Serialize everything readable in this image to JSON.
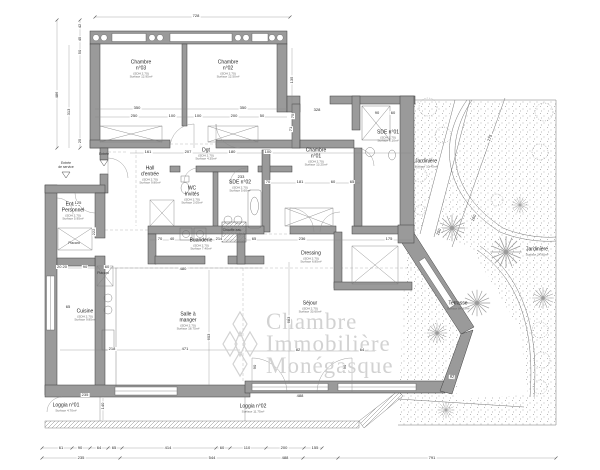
{
  "title": "Plan d'appartement",
  "watermark": {
    "line1": "Chambre",
    "line2": "Immobilière",
    "line3": "Monégasque",
    "color": "#d2d2d2"
  },
  "plan": {
    "rooms": [
      {
        "id": "chambre-03",
        "label": "Chambre\nn°03",
        "sub": [
          "(SDH 2.70)",
          "Surface 12.95m²"
        ],
        "x": 141,
        "y": 70
      },
      {
        "id": "chambre-02",
        "label": "Chambre\nn°02",
        "sub": [
          "(SDH 2.70)",
          "Surface 12.50m²"
        ],
        "x": 228,
        "y": 70
      },
      {
        "id": "chambre-01",
        "label": "Chambre\nn°01",
        "sub": [
          "(SDH 2.70)",
          "Surface 13.25m²"
        ],
        "x": 316,
        "y": 158
      },
      {
        "id": "hall-entree",
        "label": "Hall\nd'entrée",
        "sub": [
          "(SDH 2.70)",
          "Surface 9.80m²"
        ],
        "x": 150,
        "y": 176
      },
      {
        "id": "wc-invites",
        "label": "WC\nInvités",
        "sub": [
          "(SDH 2.70)",
          "Surface 2.05m²"
        ],
        "x": 192,
        "y": 196
      },
      {
        "id": "degagement",
        "label": "Dgt",
        "sub": [
          "(SDH 2.70)",
          "Surface 4.35m²"
        ],
        "x": 206,
        "y": 155
      },
      {
        "id": "sde-02",
        "label": "SDE n°02",
        "sub": [
          "(SDH 2.70)",
          "Surface 5.60m²"
        ],
        "x": 240,
        "y": 187
      },
      {
        "id": "sde-01",
        "label": "SDE n°01",
        "sub": [
          "(SDH 2.70)",
          "Surface 6.10m²"
        ],
        "x": 388,
        "y": 137
      },
      {
        "id": "dressing",
        "label": "Dressing",
        "sub": [
          "(SDH 2.70)",
          "Surface 6.85m²"
        ],
        "x": 311,
        "y": 258
      },
      {
        "id": "buanderie",
        "label": "Buanderie",
        "sub": [
          "(SDH 2.70)",
          "Surface 7.40m²"
        ],
        "x": 201,
        "y": 245
      },
      {
        "id": "chauffe-eau",
        "label": "Chauffe-eau",
        "sub": [],
        "small": true,
        "x": 232,
        "y": 231
      },
      {
        "id": "entree-service",
        "label": "Entrée\nde service",
        "sub": [],
        "small": true,
        "x": 66,
        "y": 166
      },
      {
        "id": "entree",
        "label": "Entrée",
        "sub": [],
        "small": true,
        "x": 104,
        "y": 155
      },
      {
        "id": "entree-personnel",
        "label": "Entrée\nPersonnel",
        "sub": [
          "(SDH 2.70)",
          "Surface 5.95m²"
        ],
        "x": 73,
        "y": 212
      },
      {
        "id": "placard-1",
        "label": "Placard",
        "sub": [],
        "small": true,
        "x": 74,
        "y": 244
      },
      {
        "id": "placard-2",
        "label": "Placard",
        "sub": [],
        "small": true,
        "x": 103,
        "y": 274
      },
      {
        "id": "cuisine",
        "label": "Cuisine",
        "sub": [
          "(SDH 2.70)",
          "Surface 9.85m²"
        ],
        "x": 85,
        "y": 316
      },
      {
        "id": "salle-a-manger",
        "label": "Salle à\nmanger",
        "sub": [
          "(SDH 2.70)",
          "Surface 18.75m²"
        ],
        "x": 188,
        "y": 322
      },
      {
        "id": "sejour",
        "label": "Séjour",
        "sub": [
          "(SDH 2.70)",
          "Surface 33.60m²"
        ],
        "x": 310,
        "y": 308
      },
      {
        "id": "loggia-01",
        "label": "Loggia n°01",
        "sub": [
          "Surface 4.70m²"
        ],
        "x": 66,
        "y": 408
      },
      {
        "id": "loggia-02",
        "label": "Loggia n°02",
        "sub": [
          "Surface 11.75m²"
        ],
        "x": 253,
        "y": 409
      },
      {
        "id": "terrasse",
        "label": "Terrasse",
        "sub": [
          "Surface 84.95m²"
        ],
        "x": 458,
        "y": 306
      },
      {
        "id": "jardiniere-1",
        "label": "Jardinière",
        "sub": [
          "Surface 10.45m²"
        ],
        "x": 426,
        "y": 164
      },
      {
        "id": "jardiniere-2",
        "label": "Jardinière",
        "sub": [
          "Surface 24.80m²"
        ],
        "x": 537,
        "y": 252
      }
    ],
    "dimensions": [
      {
        "t": "728",
        "x": 196,
        "y": 16
      },
      {
        "t": "350",
        "x": 137,
        "y": 108
      },
      {
        "t": "350",
        "x": 243,
        "y": 108
      },
      {
        "t": "250",
        "x": 134,
        "y": 116
      },
      {
        "t": "100",
        "x": 172,
        "y": 116
      },
      {
        "t": "100",
        "x": 198,
        "y": 116
      },
      {
        "t": "200",
        "x": 234,
        "y": 116
      },
      {
        "t": "50",
        "x": 262,
        "y": 116
      },
      {
        "t": "42",
        "x": 80,
        "y": 26,
        "rot": -90
      },
      {
        "t": "45",
        "x": 80,
        "y": 39,
        "rot": -90
      },
      {
        "t": "50",
        "x": 80,
        "y": 52,
        "rot": -90
      },
      {
        "t": "486",
        "x": 57,
        "y": 95,
        "rot": -90
      },
      {
        "t": "313",
        "x": 69,
        "y": 112,
        "rot": -90
      },
      {
        "t": "25",
        "x": 80,
        "y": 141,
        "rot": -90
      },
      {
        "t": "135",
        "x": 292,
        "y": 80,
        "rot": -90
      },
      {
        "t": "75",
        "x": 293,
        "y": 116,
        "rot": -90
      },
      {
        "t": "71",
        "x": 291,
        "y": 129,
        "rot": -90
      },
      {
        "t": "161",
        "x": 148,
        "y": 152
      },
      {
        "t": "207",
        "x": 188,
        "y": 152
      },
      {
        "t": "180",
        "x": 232,
        "y": 152
      },
      {
        "t": "100",
        "x": 268,
        "y": 152
      },
      {
        "t": "328",
        "x": 317,
        "y": 110
      },
      {
        "t": "90",
        "x": 377,
        "y": 113
      },
      {
        "t": "60",
        "x": 393,
        "y": 113
      },
      {
        "t": "70",
        "x": 268,
        "y": 182
      },
      {
        "t": "181",
        "x": 300,
        "y": 182
      },
      {
        "t": "60",
        "x": 333,
        "y": 182
      },
      {
        "t": "65",
        "x": 352,
        "y": 182
      },
      {
        "t": "233",
        "x": 241,
        "y": 177
      },
      {
        "t": "236",
        "x": 302,
        "y": 239
      },
      {
        "t": "175",
        "x": 389,
        "y": 239
      },
      {
        "t": "70",
        "x": 160,
        "y": 239
      },
      {
        "t": "40",
        "x": 172,
        "y": 239
      },
      {
        "t": "214",
        "x": 219,
        "y": 239
      },
      {
        "t": "65",
        "x": 254,
        "y": 239
      },
      {
        "t": "480",
        "x": 183,
        "y": 269
      },
      {
        "t": "125",
        "x": 78,
        "y": 203
      },
      {
        "t": "222",
        "x": 94,
        "y": 232,
        "rot": -90
      },
      {
        "t": "20  20",
        "x": 62,
        "y": 267
      },
      {
        "t": "90",
        "x": 85,
        "y": 267
      },
      {
        "t": "60",
        "x": 107,
        "y": 267
      },
      {
        "t": "218",
        "x": 112,
        "y": 349
      },
      {
        "t": "65",
        "x": 68,
        "y": 307
      },
      {
        "t": "471",
        "x": 185,
        "y": 349
      },
      {
        "t": "603",
        "x": 209,
        "y": 337,
        "rot": -90
      },
      {
        "t": "683",
        "x": 289,
        "y": 320,
        "rot": -90
      },
      {
        "t": "82",
        "x": 298,
        "y": 350
      },
      {
        "t": "64",
        "x": 362,
        "y": 350
      },
      {
        "t": "90",
        "x": 255,
        "y": 367,
        "rot": -90
      },
      {
        "t": "90",
        "x": 345,
        "y": 367,
        "rot": -90
      },
      {
        "t": "235",
        "x": 85,
        "y": 395
      },
      {
        "t": "488",
        "x": 300,
        "y": 396
      },
      {
        "t": "140",
        "x": 103,
        "y": 406,
        "rot": -90
      },
      {
        "t": "275",
        "x": 490,
        "y": 138,
        "rot": -70
      },
      {
        "t": "160",
        "x": 474,
        "y": 218,
        "rot": -70
      },
      {
        "t": "150",
        "x": 439,
        "y": 232,
        "rot": -70
      },
      {
        "t": "92",
        "x": 452,
        "y": 377,
        "rot": 4
      },
      {
        "t": "61",
        "x": 61,
        "y": 448
      },
      {
        "t": "90",
        "x": 80,
        "y": 448
      },
      {
        "t": "64",
        "x": 99,
        "y": 448
      },
      {
        "t": "65",
        "x": 114,
        "y": 448
      },
      {
        "t": "414",
        "x": 168,
        "y": 448
      },
      {
        "t": "60",
        "x": 222,
        "y": 448
      },
      {
        "t": "110",
        "x": 247,
        "y": 448
      },
      {
        "t": "200",
        "x": 284,
        "y": 448
      },
      {
        "t": "155",
        "x": 315,
        "y": 448
      },
      {
        "t": "235",
        "x": 81,
        "y": 458
      },
      {
        "t": "544",
        "x": 212,
        "y": 458
      },
      {
        "t": "488",
        "x": 285,
        "y": 458
      },
      {
        "t": "791",
        "x": 432,
        "y": 458
      }
    ]
  }
}
